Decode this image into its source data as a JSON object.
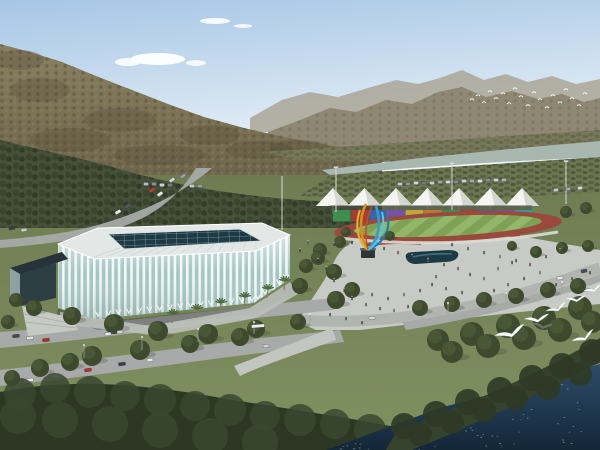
{
  "palette": {
    "sky_top": "#a6c6e6",
    "sky_mid": "#cfe0f0",
    "sky_bottom": "#f0f5fa",
    "cloud": "#ffffff",
    "far_ridge": "#a49d8b",
    "ridge": "#8f8874",
    "hill_top": "#8a7f60",
    "hill_bottom": "#6d664c",
    "valley": "#78785c",
    "river": "#a9b7b1",
    "orchard": "#6d7652",
    "tree_band": "#46513a",
    "ground_top": "#6f7c52",
    "ground_bottom": "#7f9161",
    "lawn": "#7d8f5f",
    "flower": "#a03c34",
    "road": "#a7aaa8",
    "road_light": "#c3c5c1",
    "plaza": "#c8cac6",
    "plaza_inner": "#aeb1ac",
    "stadium_roof": "#e3e8e6",
    "skylight": "#1f3a44",
    "skylight_grid": "#7fa6ac",
    "facade_glass": "#a2c6c2",
    "facade_rib": "#f3f7f6",
    "entrance_glass": "#2e3f44",
    "canopy": "#27333a",
    "entrance_side": "#8fa0a0",
    "apron": "#bcc0ba",
    "stair": "#c6c9c4",
    "track": "#9a4a3c",
    "field": "#7da256",
    "field_stripe": "#92b768",
    "fence": "#dcdcd6",
    "tent": "#f4f4f1",
    "tent_shade": "#d6d6d0",
    "tent_pole": "#8a8a88",
    "tent_shadow": "#4a4a46",
    "pool": "#1d3943",
    "pool_hl": "#4a7e8c",
    "pedestal": "#2e3438",
    "forest": "#2c3824",
    "forest_bump": "#3a4830",
    "shore_tree": "#35422c",
    "water_top": "#2e4c68",
    "water_bottom": "#132738",
    "sparkle": "#d6e6f0",
    "boat": "#e9eff3",
    "tree_dark": "#3d4a2e",
    "tree_light": "#4c5c38",
    "trunk": "#8a7a5a",
    "palm": "#4a6a3a",
    "bird": "#ffffff",
    "bird_dark": "#6a6a60",
    "pole": "#d8d8d4",
    "shadow": "#333333"
  },
  "scene": {
    "clouds": [
      {
        "cx": 215,
        "cy": 21,
        "rx": 15,
        "ry": 3,
        "o": 0.9
      },
      {
        "cx": 243,
        "cy": 26,
        "rx": 9,
        "ry": 2,
        "o": 0.8
      },
      {
        "cx": 158,
        "cy": 59,
        "rx": 27,
        "ry": 6,
        "o": 0.95
      },
      {
        "cx": 128,
        "cy": 62,
        "rx": 13,
        "ry": 4,
        "o": 0.85
      },
      {
        "cx": 196,
        "cy": 63,
        "rx": 10,
        "ry": 3,
        "o": 0.8
      }
    ],
    "hill_patches": [
      [
        40,
        90,
        30,
        12
      ],
      [
        120,
        120,
        36,
        12
      ],
      [
        210,
        135,
        30,
        10
      ],
      [
        70,
        140,
        40,
        12
      ],
      [
        160,
        155,
        46,
        10
      ],
      [
        260,
        150,
        34,
        9
      ],
      [
        20,
        60,
        24,
        10
      ],
      [
        300,
        148,
        30,
        8
      ]
    ],
    "flock_points": [
      [
        472,
        100
      ],
      [
        478,
        96
      ],
      [
        484,
        103
      ],
      [
        490,
        92
      ],
      [
        496,
        99
      ],
      [
        503,
        94
      ],
      [
        509,
        104
      ],
      [
        515,
        89
      ],
      [
        521,
        97
      ],
      [
        528,
        106
      ],
      [
        534,
        93
      ],
      [
        540,
        100
      ],
      [
        547,
        108
      ],
      [
        553,
        96
      ],
      [
        560,
        103
      ],
      [
        566,
        90
      ],
      [
        572,
        99
      ],
      [
        579,
        106
      ],
      [
        585,
        94
      ]
    ],
    "gulls": [
      {
        "x": 512,
        "y": 334,
        "s": 1.7,
        "r": -18,
        "c": "#ffffff"
      },
      {
        "x": 538,
        "y": 320,
        "s": 1.35,
        "r": -8,
        "c": "#ffffff"
      },
      {
        "x": 558,
        "y": 309,
        "s": 1.2,
        "r": -22,
        "c": "#ffffff"
      },
      {
        "x": 577,
        "y": 300,
        "s": 1.1,
        "r": -6,
        "c": "#ffffff"
      },
      {
        "x": 594,
        "y": 290,
        "s": 1.0,
        "r": -18,
        "c": "#ffffff"
      },
      {
        "x": 543,
        "y": 327,
        "s": 1.0,
        "r": 8,
        "c": "#6a6a60"
      },
      {
        "x": 585,
        "y": 338,
        "s": 1.3,
        "r": -26,
        "c": "#ffffff"
      }
    ],
    "tents": {
      "start_x": 333,
      "step": 31.5,
      "count": 7,
      "apex_y": 188,
      "base_y": 206,
      "half_w": 17,
      "pole_bottom": 214
    },
    "wall_segments": [
      "#3e8e4e",
      "#a83c34",
      "#3b62aa",
      "#7452a8",
      "#c2a63c",
      "#bd7634",
      "#3e8e4e",
      "#a83c34",
      "#3b62aa",
      "#7452a8",
      "#38989a"
    ],
    "wall_geo": {
      "x": 333,
      "y": 210,
      "w": 18.2,
      "h": 11.5
    },
    "masts": [
      [
        336,
        212,
        44
      ],
      [
        452,
        210,
        46
      ],
      [
        566,
        204,
        42
      ],
      [
        282,
        230,
        54
      ]
    ],
    "lampposts": [
      [
        84,
        358,
        13
      ],
      [
        142,
        350,
        13
      ],
      [
        198,
        342,
        13
      ],
      [
        254,
        334,
        12
      ],
      [
        310,
        326,
        12
      ],
      [
        448,
        314,
        11
      ],
      [
        506,
        304,
        11
      ],
      [
        562,
        292,
        10
      ]
    ],
    "roof_ribs": {
      "n": 13,
      "outer": [
        94,
        257,
        256,
        249
      ],
      "inner": [
        120,
        248,
        256,
        242
      ]
    },
    "chevron_edges": [
      {
        "x1": 98,
        "y1": 316,
        "x2": 252,
        "y2": 301,
        "n": 15
      },
      {
        "x1": 258,
        "y1": 299,
        "x2": 286,
        "y2": 279,
        "n": 4
      }
    ],
    "palms": [
      [
        196,
        318
      ],
      [
        220,
        312
      ],
      [
        244,
        306
      ],
      [
        267,
        298
      ],
      [
        284,
        290
      ],
      [
        172,
        323
      ]
    ],
    "trees": [
      [
        34,
        308,
        8
      ],
      [
        72,
        316,
        9
      ],
      [
        114,
        324,
        10
      ],
      [
        158,
        331,
        10
      ],
      [
        208,
        334,
        10
      ],
      [
        256,
        329,
        9
      ],
      [
        298,
        322,
        8
      ],
      [
        92,
        356,
        10
      ],
      [
        140,
        350,
        10
      ],
      [
        190,
        344,
        9
      ],
      [
        240,
        337,
        9
      ],
      [
        300,
        286,
        8
      ],
      [
        306,
        266,
        7
      ],
      [
        320,
        250,
        7
      ],
      [
        336,
        300,
        9
      ],
      [
        352,
        290,
        8
      ],
      [
        334,
        272,
        8
      ],
      [
        318,
        258,
        7
      ],
      [
        340,
        242,
        6
      ],
      [
        420,
        308,
        8
      ],
      [
        452,
        304,
        8
      ],
      [
        484,
        300,
        8
      ],
      [
        516,
        296,
        8
      ],
      [
        548,
        290,
        8
      ],
      [
        578,
        286,
        8
      ],
      [
        536,
        252,
        6
      ],
      [
        562,
        248,
        6
      ],
      [
        588,
        246,
        6
      ],
      [
        512,
        246,
        5
      ],
      [
        566,
        212,
        6
      ],
      [
        586,
        208,
        6
      ],
      [
        390,
        236,
        5
      ],
      [
        346,
        232,
        5
      ],
      [
        438,
        340,
        11
      ],
      [
        472,
        334,
        12
      ],
      [
        508,
        326,
        12
      ],
      [
        544,
        318,
        12
      ],
      [
        580,
        308,
        12
      ],
      [
        452,
        352,
        11
      ],
      [
        488,
        346,
        12
      ],
      [
        524,
        338,
        12
      ],
      [
        560,
        330,
        12
      ],
      [
        592,
        322,
        11
      ],
      [
        16,
        300,
        7
      ],
      [
        8,
        322,
        7
      ],
      [
        40,
        368,
        9
      ],
      [
        12,
        378,
        8
      ],
      [
        70,
        362,
        9
      ]
    ],
    "forest_bumps": [
      [
        20,
        394,
        16
      ],
      [
        55,
        388,
        15
      ],
      [
        90,
        392,
        16
      ],
      [
        125,
        396,
        15
      ],
      [
        160,
        400,
        16
      ],
      [
        195,
        406,
        15
      ],
      [
        230,
        410,
        16
      ],
      [
        265,
        416,
        15
      ],
      [
        300,
        420,
        16
      ],
      [
        335,
        424,
        15
      ],
      [
        370,
        430,
        16
      ],
      [
        405,
        436,
        15
      ],
      [
        18,
        416,
        18
      ],
      [
        60,
        420,
        18
      ],
      [
        110,
        424,
        18
      ],
      [
        160,
        430,
        18
      ],
      [
        210,
        436,
        18
      ],
      [
        260,
        442,
        18
      ]
    ],
    "shore_bumps": [
      [
        404,
        426,
        13
      ],
      [
        436,
        414,
        13
      ],
      [
        468,
        402,
        13
      ],
      [
        500,
        390,
        13
      ],
      [
        532,
        378,
        13
      ],
      [
        562,
        366,
        13
      ],
      [
        592,
        352,
        13
      ],
      [
        420,
        434,
        12
      ],
      [
        452,
        422,
        12
      ],
      [
        484,
        410,
        12
      ],
      [
        516,
        398,
        12
      ],
      [
        548,
        388,
        12
      ],
      [
        580,
        374,
        12
      ]
    ],
    "cars": [
      [
        172,
        180,
        "#cfd4d8",
        -35,
        6
      ],
      [
        183,
        176,
        "#9aa0a4",
        -35,
        6
      ],
      [
        152,
        190,
        "#c23a32",
        -35,
        6
      ],
      [
        160,
        194,
        "#e8e8e8",
        -35,
        6
      ],
      [
        128,
        206,
        "#555a60",
        -30,
        6
      ],
      [
        118,
        212,
        "#e8e8e8",
        -30,
        6
      ],
      [
        146,
        184,
        "#b8bcc0",
        0,
        5
      ],
      [
        154,
        184,
        "#8a9094",
        0,
        5
      ],
      [
        162,
        185,
        "#d0d4d8",
        0,
        5
      ],
      [
        170,
        185,
        "#777c80",
        0,
        5
      ],
      [
        192,
        186,
        "#c8ccd0",
        0,
        5
      ],
      [
        200,
        186,
        "#989ca0",
        0,
        5
      ],
      [
        12,
        228,
        "#3a3e44",
        -8,
        6
      ],
      [
        24,
        230,
        "#caced2",
        -8,
        6
      ],
      [
        16,
        336,
        "#44484e",
        -6,
        7
      ],
      [
        30,
        338,
        "#e0e2e4",
        -6,
        7
      ],
      [
        46,
        340,
        "#b03028",
        -6,
        7
      ],
      [
        108,
        334,
        "#e8e8e8",
        -8,
        6
      ],
      [
        120,
        332,
        "#d8d8d8",
        -8,
        6
      ],
      [
        30,
        380,
        "#e4e6e8",
        -8,
        7
      ],
      [
        56,
        376,
        "#d8dadc",
        -8,
        7
      ],
      [
        88,
        370,
        "#b8322a",
        -8,
        7
      ],
      [
        122,
        364,
        "#3c4046",
        -8,
        7
      ],
      [
        150,
        360,
        "#e8e8e8",
        -8,
        6
      ],
      [
        266,
        346,
        "#d0d2d4",
        -6,
        6
      ],
      [
        258,
        326,
        "#eceeee",
        -5,
        13
      ],
      [
        560,
        278,
        "#e8eaec",
        -12,
        6
      ],
      [
        584,
        271,
        "#484c52",
        -12,
        6
      ],
      [
        372,
        318,
        "#d8dadc",
        -4,
        6
      ],
      [
        556,
        190,
        "#c8ccd0",
        -4,
        5
      ],
      [
        568,
        189,
        "#a8acb0",
        -4,
        5
      ],
      [
        580,
        188,
        "#d8dcde",
        -4,
        5
      ],
      [
        400,
        184,
        "#c4c8cc",
        0,
        5
      ],
      [
        408,
        184,
        "#8e9296",
        0,
        5
      ],
      [
        416,
        183,
        "#d2d6da",
        0,
        5
      ],
      [
        424,
        183,
        "#767a7e",
        0,
        5
      ],
      [
        432,
        183,
        "#c8ccd0",
        0,
        5
      ],
      [
        440,
        182,
        "#9ea2a6",
        0,
        5
      ],
      [
        448,
        182,
        "#d6dade",
        0,
        5
      ],
      [
        456,
        182,
        "#84888c",
        0,
        5
      ],
      [
        464,
        181,
        "#ccd0d4",
        0,
        5
      ],
      [
        472,
        181,
        "#a4a8ac",
        0,
        5
      ],
      [
        480,
        181,
        "#dadee2",
        0,
        5
      ],
      [
        488,
        180,
        "#8c9094",
        0,
        5
      ],
      [
        496,
        180,
        "#d0d4d8",
        0,
        5
      ],
      [
        504,
        180,
        "#b0b4b8",
        0,
        5
      ]
    ],
    "people": [
      [
        318,
        262
      ],
      [
        326,
        270
      ],
      [
        334,
        282
      ],
      [
        344,
        292
      ],
      [
        352,
        300
      ],
      [
        366,
        306
      ],
      [
        380,
        310
      ],
      [
        394,
        312
      ],
      [
        408,
        308
      ],
      [
        334,
        246
      ],
      [
        352,
        244
      ],
      [
        368,
        246
      ],
      [
        384,
        250
      ],
      [
        398,
        254
      ],
      [
        412,
        258
      ],
      [
        428,
        262
      ],
      [
        444,
        266
      ],
      [
        458,
        270
      ],
      [
        470,
        276
      ],
      [
        484,
        280
      ],
      [
        432,
        286
      ],
      [
        446,
        290
      ],
      [
        462,
        294
      ],
      [
        478,
        298
      ],
      [
        494,
        292
      ],
      [
        508,
        286
      ],
      [
        524,
        280
      ],
      [
        540,
        274
      ],
      [
        452,
        246
      ],
      [
        468,
        250
      ],
      [
        484,
        254
      ],
      [
        500,
        258
      ],
      [
        516,
        262
      ],
      [
        530,
        266
      ],
      [
        546,
        258
      ],
      [
        560,
        252
      ],
      [
        330,
        316
      ],
      [
        346,
        320
      ],
      [
        362,
        324
      ],
      [
        498,
        270
      ],
      [
        512,
        264
      ],
      [
        372,
        296
      ],
      [
        388,
        300
      ],
      [
        404,
        296
      ],
      [
        420,
        292
      ],
      [
        436,
        278
      ],
      [
        300,
        252
      ],
      [
        308,
        244
      ],
      [
        556,
        286
      ],
      [
        572,
        280
      ],
      [
        590,
        274
      ]
    ],
    "people_colors": [
      "#2e2e36",
      "#4a3a32",
      "#263248",
      "#55555f"
    ],
    "sparkles": {
      "count": 70
    },
    "boat": {
      "x": 534,
      "y": 385
    }
  }
}
